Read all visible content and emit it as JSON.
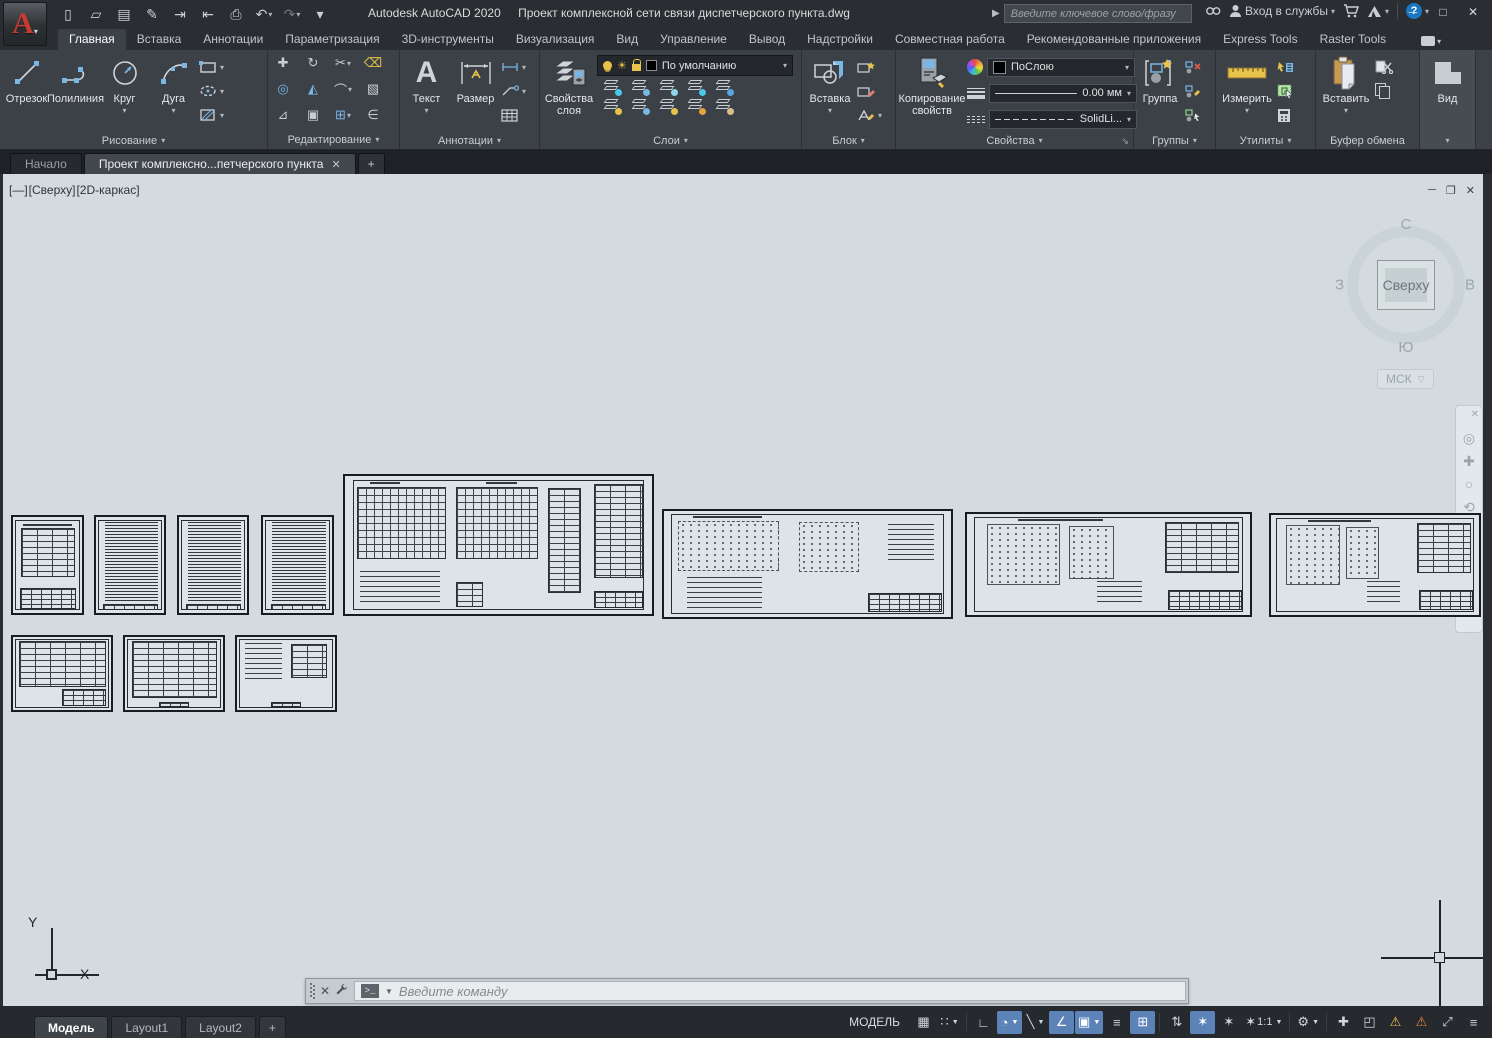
{
  "titlebar": {
    "app_title": "Autodesk AutoCAD 2020",
    "doc_title": "Проект комплексной сети связи диспетчерского пункта.dwg",
    "search_placeholder": "Введите ключевое слово/фразу",
    "signin_label": "Вход в службы",
    "help_glyph": "?",
    "quick_access_icons": [
      {
        "name": "new-document-icon",
        "glyph": "▯"
      },
      {
        "name": "open-icon",
        "glyph": "▱"
      },
      {
        "name": "save-icon",
        "glyph": "▤"
      },
      {
        "name": "save-as-icon",
        "glyph": "✎"
      },
      {
        "name": "open-web-mobile-icon",
        "glyph": "⇥"
      },
      {
        "name": "save-web-mobile-icon",
        "glyph": "⇤"
      },
      {
        "name": "plot-icon",
        "glyph": "⎙"
      },
      {
        "name": "undo-icon",
        "glyph": "↶",
        "dd": true
      },
      {
        "name": "redo-icon",
        "glyph": "↷",
        "dd": true,
        "dim": true
      },
      {
        "name": "customize-qat-icon",
        "glyph": "▾"
      }
    ],
    "window_buttons": [
      {
        "name": "minimize-button",
        "glyph": "─"
      },
      {
        "name": "maximize-button",
        "glyph": "□"
      },
      {
        "name": "close-button",
        "glyph": "✕"
      }
    ]
  },
  "ribbon": {
    "tabs": [
      {
        "label": "Главная",
        "active": true
      },
      {
        "label": "Вставка"
      },
      {
        "label": "Аннотации"
      },
      {
        "label": "Параметризация"
      },
      {
        "label": "3D-инструменты"
      },
      {
        "label": "Визуализация"
      },
      {
        "label": "Вид"
      },
      {
        "label": "Управление"
      },
      {
        "label": "Вывод"
      },
      {
        "label": "Надстройки"
      },
      {
        "label": "Совместная работа"
      },
      {
        "label": "Рекомендованные приложения"
      },
      {
        "label": "Express Tools"
      },
      {
        "label": "Raster Tools"
      }
    ],
    "panels": {
      "draw": {
        "label": "Рисование",
        "line": "Отрезок",
        "polyline": "Полилиния",
        "circle": "Круг",
        "arc": "Дуга"
      },
      "modify": {
        "label": "Редактирование"
      },
      "annotation": {
        "label": "Аннотации",
        "text": "Текст",
        "dimension": "Размер"
      },
      "layers": {
        "label": "Слои",
        "layer_properties": "Свойства слоя",
        "current_layer": "По умолчанию"
      },
      "block": {
        "label": "Блок",
        "insert": "Вставка"
      },
      "properties": {
        "label": "Свойства",
        "match": "Копирование свойств",
        "color": "ПоСлою",
        "lineweight": "0.00 мм",
        "linetype": "SolidLi..."
      },
      "groups": {
        "label": "Группы",
        "group": "Группа"
      },
      "utilities": {
        "label": "Утилиты",
        "measure": "Измерить"
      },
      "clipboard": {
        "label": "Буфер обмена",
        "paste": "Вставить"
      },
      "view": {
        "label": "Вид"
      }
    }
  },
  "file_tabs": {
    "items": [
      {
        "label": "Начало"
      },
      {
        "label": "Проект комплексно...петчерского пункта",
        "active": true,
        "closable": true
      }
    ],
    "new_tab_glyph": "+"
  },
  "viewport": {
    "controls": [
      "[—]",
      "[Сверху]",
      "[2D-каркас]"
    ],
    "window_buttons": [
      {
        "name": "vp-minimize-icon",
        "glyph": "─"
      },
      {
        "name": "vp-restore-icon",
        "glyph": "❐"
      },
      {
        "name": "vp-close-icon",
        "glyph": "✕"
      }
    ]
  },
  "viewcube": {
    "north": "С",
    "south": "Ю",
    "west": "З",
    "east": "В",
    "face": "Сверху",
    "ucs": "МСК"
  },
  "navbar_icons": [
    {
      "name": "navbar-close-icon",
      "glyph": "✕",
      "sm": true
    },
    {
      "name": "steering-wheel-icon",
      "glyph": "◎"
    },
    {
      "name": "pan-icon",
      "glyph": "✚"
    },
    {
      "name": "zoom-icon",
      "glyph": "○"
    },
    {
      "name": "orbit-icon",
      "glyph": "⟲"
    },
    {
      "name": "show-motion-icon",
      "glyph": "▤"
    }
  ],
  "command_line": {
    "placeholder": "Введите  команду"
  },
  "statusbar": {
    "layout_tabs": [
      {
        "label": "Модель",
        "active": true
      },
      {
        "label": "Layout1"
      },
      {
        "label": "Layout2"
      }
    ],
    "new_layout_glyph": "+",
    "mode_label": "МОДЕЛЬ",
    "toggles": [
      {
        "name": "grid-toggle",
        "glyph": "▦"
      },
      {
        "name": "snap-mode-toggle",
        "glyph": "∷",
        "dd": true
      },
      {
        "name": "sep"
      },
      {
        "name": "ortho-toggle",
        "glyph": "∟"
      },
      {
        "name": "polar-tracking-toggle",
        "glyph": "◔",
        "active": true,
        "dd": true
      },
      {
        "name": "isometric-drafting-toggle",
        "glyph": "╲",
        "dd": true
      },
      {
        "name": "object-snap-tracking-toggle",
        "glyph": "∠",
        "active": true
      },
      {
        "name": "object-snap-toggle",
        "glyph": "▣",
        "active": true,
        "dd": true
      },
      {
        "name": "lineweight-toggle",
        "glyph": "≡"
      },
      {
        "name": "transparency-toggle",
        "glyph": "⊞",
        "active": true
      },
      {
        "name": "sep"
      },
      {
        "name": "selection-cycling-toggle",
        "glyph": "⇅"
      },
      {
        "name": "annotation-visibility-toggle",
        "glyph": "✶",
        "active": true
      },
      {
        "name": "autoscale-toggle",
        "glyph": "✶"
      },
      {
        "name": "annotation-scale-button",
        "glyph": "✶",
        "label": "1:1",
        "dd": true
      },
      {
        "name": "sep"
      },
      {
        "name": "workspace-switching-button",
        "glyph": "⚙",
        "dd": true
      },
      {
        "name": "sep"
      },
      {
        "name": "crosshair-button",
        "glyph": "✚"
      },
      {
        "name": "isolate-objects-button",
        "glyph": "◰"
      },
      {
        "name": "hardware-acceleration-warning",
        "glyph": "⚠",
        "w": 1
      },
      {
        "name": "graphics-performance-warning",
        "glyph": "⚠",
        "w": 2
      },
      {
        "name": "clean-screen-button",
        "glyph": "⤢"
      },
      {
        "name": "customize-statusbar-button",
        "glyph": "≡"
      }
    ]
  },
  "canvas": {
    "background": "#d3dbde",
    "sheets": [
      {
        "name": "sheet-contents",
        "kind": "toc",
        "x": 8,
        "y": 341,
        "w": 73,
        "h": 100
      },
      {
        "name": "sheet-text-1",
        "kind": "text",
        "x": 91,
        "y": 341,
        "w": 72,
        "h": 100
      },
      {
        "name": "sheet-text-2",
        "kind": "text",
        "x": 174,
        "y": 341,
        "w": 72,
        "h": 100
      },
      {
        "name": "sheet-text-3",
        "kind": "text",
        "x": 258,
        "y": 341,
        "w": 73,
        "h": 100
      },
      {
        "name": "sheet-floor-plans",
        "kind": "plan",
        "x": 340,
        "y": 300,
        "w": 311,
        "h": 142
      },
      {
        "name": "sheet-schematic-1",
        "kind": "schematic",
        "x": 659,
        "y": 335,
        "w": 291,
        "h": 110
      },
      {
        "name": "sheet-schematic-2",
        "kind": "schematic2",
        "x": 962,
        "y": 338,
        "w": 287,
        "h": 105
      },
      {
        "name": "sheet-schematic-3",
        "kind": "schematic2",
        "x": 1266,
        "y": 339,
        "w": 212,
        "h": 104
      },
      {
        "name": "sheet-spec-1",
        "kind": "spec",
        "x": 8,
        "y": 461,
        "w": 102,
        "h": 77
      },
      {
        "name": "sheet-spec-2",
        "kind": "spec2",
        "x": 120,
        "y": 461,
        "w": 102,
        "h": 77
      },
      {
        "name": "sheet-spec-3",
        "kind": "spec3",
        "x": 232,
        "y": 461,
        "w": 102,
        "h": 77
      }
    ]
  }
}
